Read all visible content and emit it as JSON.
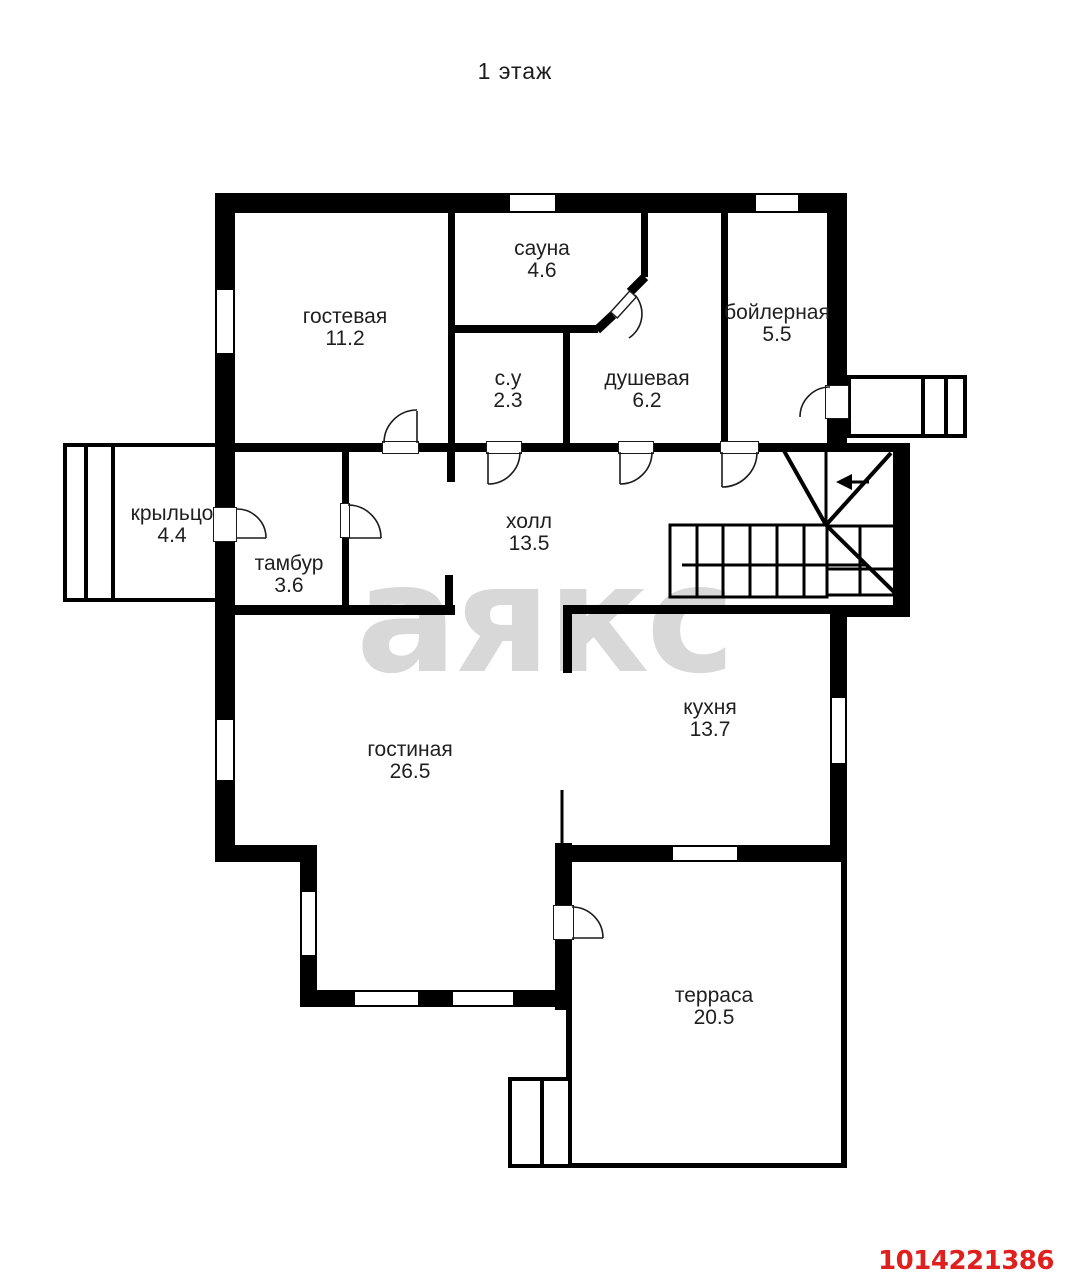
{
  "title": "1 этаж",
  "watermark_text": "аякс",
  "listing_id": "1014221386",
  "colors": {
    "wall": "#000000",
    "label_text": "#1f1f1f",
    "watermark": "#d8d8d8",
    "listing_id": "#e01f1f"
  },
  "rooms": [
    {
      "name": "гостевая",
      "area": "11.2"
    },
    {
      "name": "сауна",
      "area": "4.6"
    },
    {
      "name": "бойлерная",
      "area": "5.5"
    },
    {
      "name": "с.у",
      "area": "2.3"
    },
    {
      "name": "душевая",
      "area": "6.2"
    },
    {
      "name": "крыльцо",
      "area": "4.4"
    },
    {
      "name": "тамбур",
      "area": "3.6"
    },
    {
      "name": "холл",
      "area": "13.5"
    },
    {
      "name": "гостиная",
      "area": "26.5"
    },
    {
      "name": "кухня",
      "area": "13.7"
    },
    {
      "name": "терраса",
      "area": "20.5"
    }
  ],
  "stairs": {
    "direction_arrow": "left"
  }
}
